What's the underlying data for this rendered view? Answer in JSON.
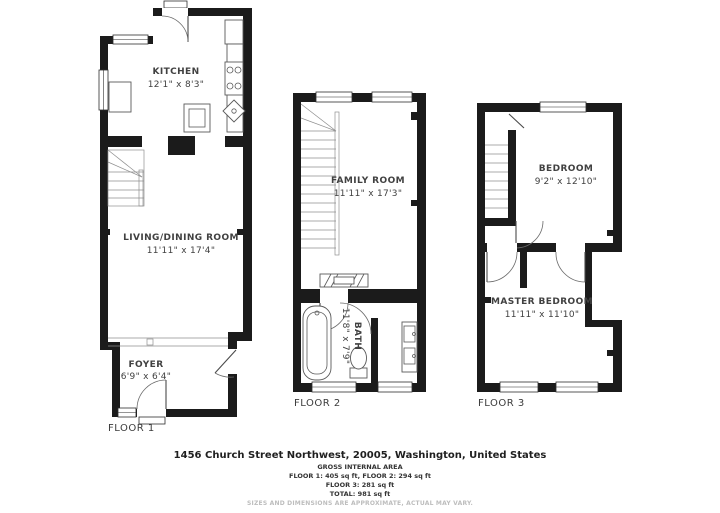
{
  "floors": [
    {
      "label": "FLOOR 1",
      "rooms": [
        {
          "name": "KITCHEN",
          "dims": "12'1\" x 8'3\""
        },
        {
          "name": "LIVING/DINING ROOM",
          "dims": "11'11\" x 17'4\""
        },
        {
          "name": "FOYER",
          "dims": "6'9\" x 6'4\""
        }
      ]
    },
    {
      "label": "FLOOR 2",
      "rooms": [
        {
          "name": "FAMILY ROOM",
          "dims": "11'11\" x 17'3\""
        },
        {
          "name": "BATH",
          "dims": "11'8\" x 7'9\""
        }
      ]
    },
    {
      "label": "FLOOR 3",
      "rooms": [
        {
          "name": "BEDROOM",
          "dims": "9'2\" x 12'10\""
        },
        {
          "name": "MASTER BEDROOM",
          "dims": "11'11\" x 11'10\""
        }
      ]
    }
  ],
  "footer": {
    "address": "1456 Church Street Northwest, 20005, Washington, United States",
    "gross_label": "GROSS INTERNAL AREA",
    "areas_line1": "FLOOR 1: 405 sq ft, FLOOR 2: 294 sq ft",
    "areas_line2": "FLOOR 3: 281 sq ft",
    "total_line": "TOTAL: 981 sq ft",
    "disclaimer": "SIZES AND DIMENSIONS ARE APPROXIMATE, ACTUAL MAY VARY."
  },
  "colors": {
    "wall": "#1b1b1b",
    "background": "#ffffff",
    "text": "#414141",
    "disclaimer": "#bdbdbd"
  }
}
